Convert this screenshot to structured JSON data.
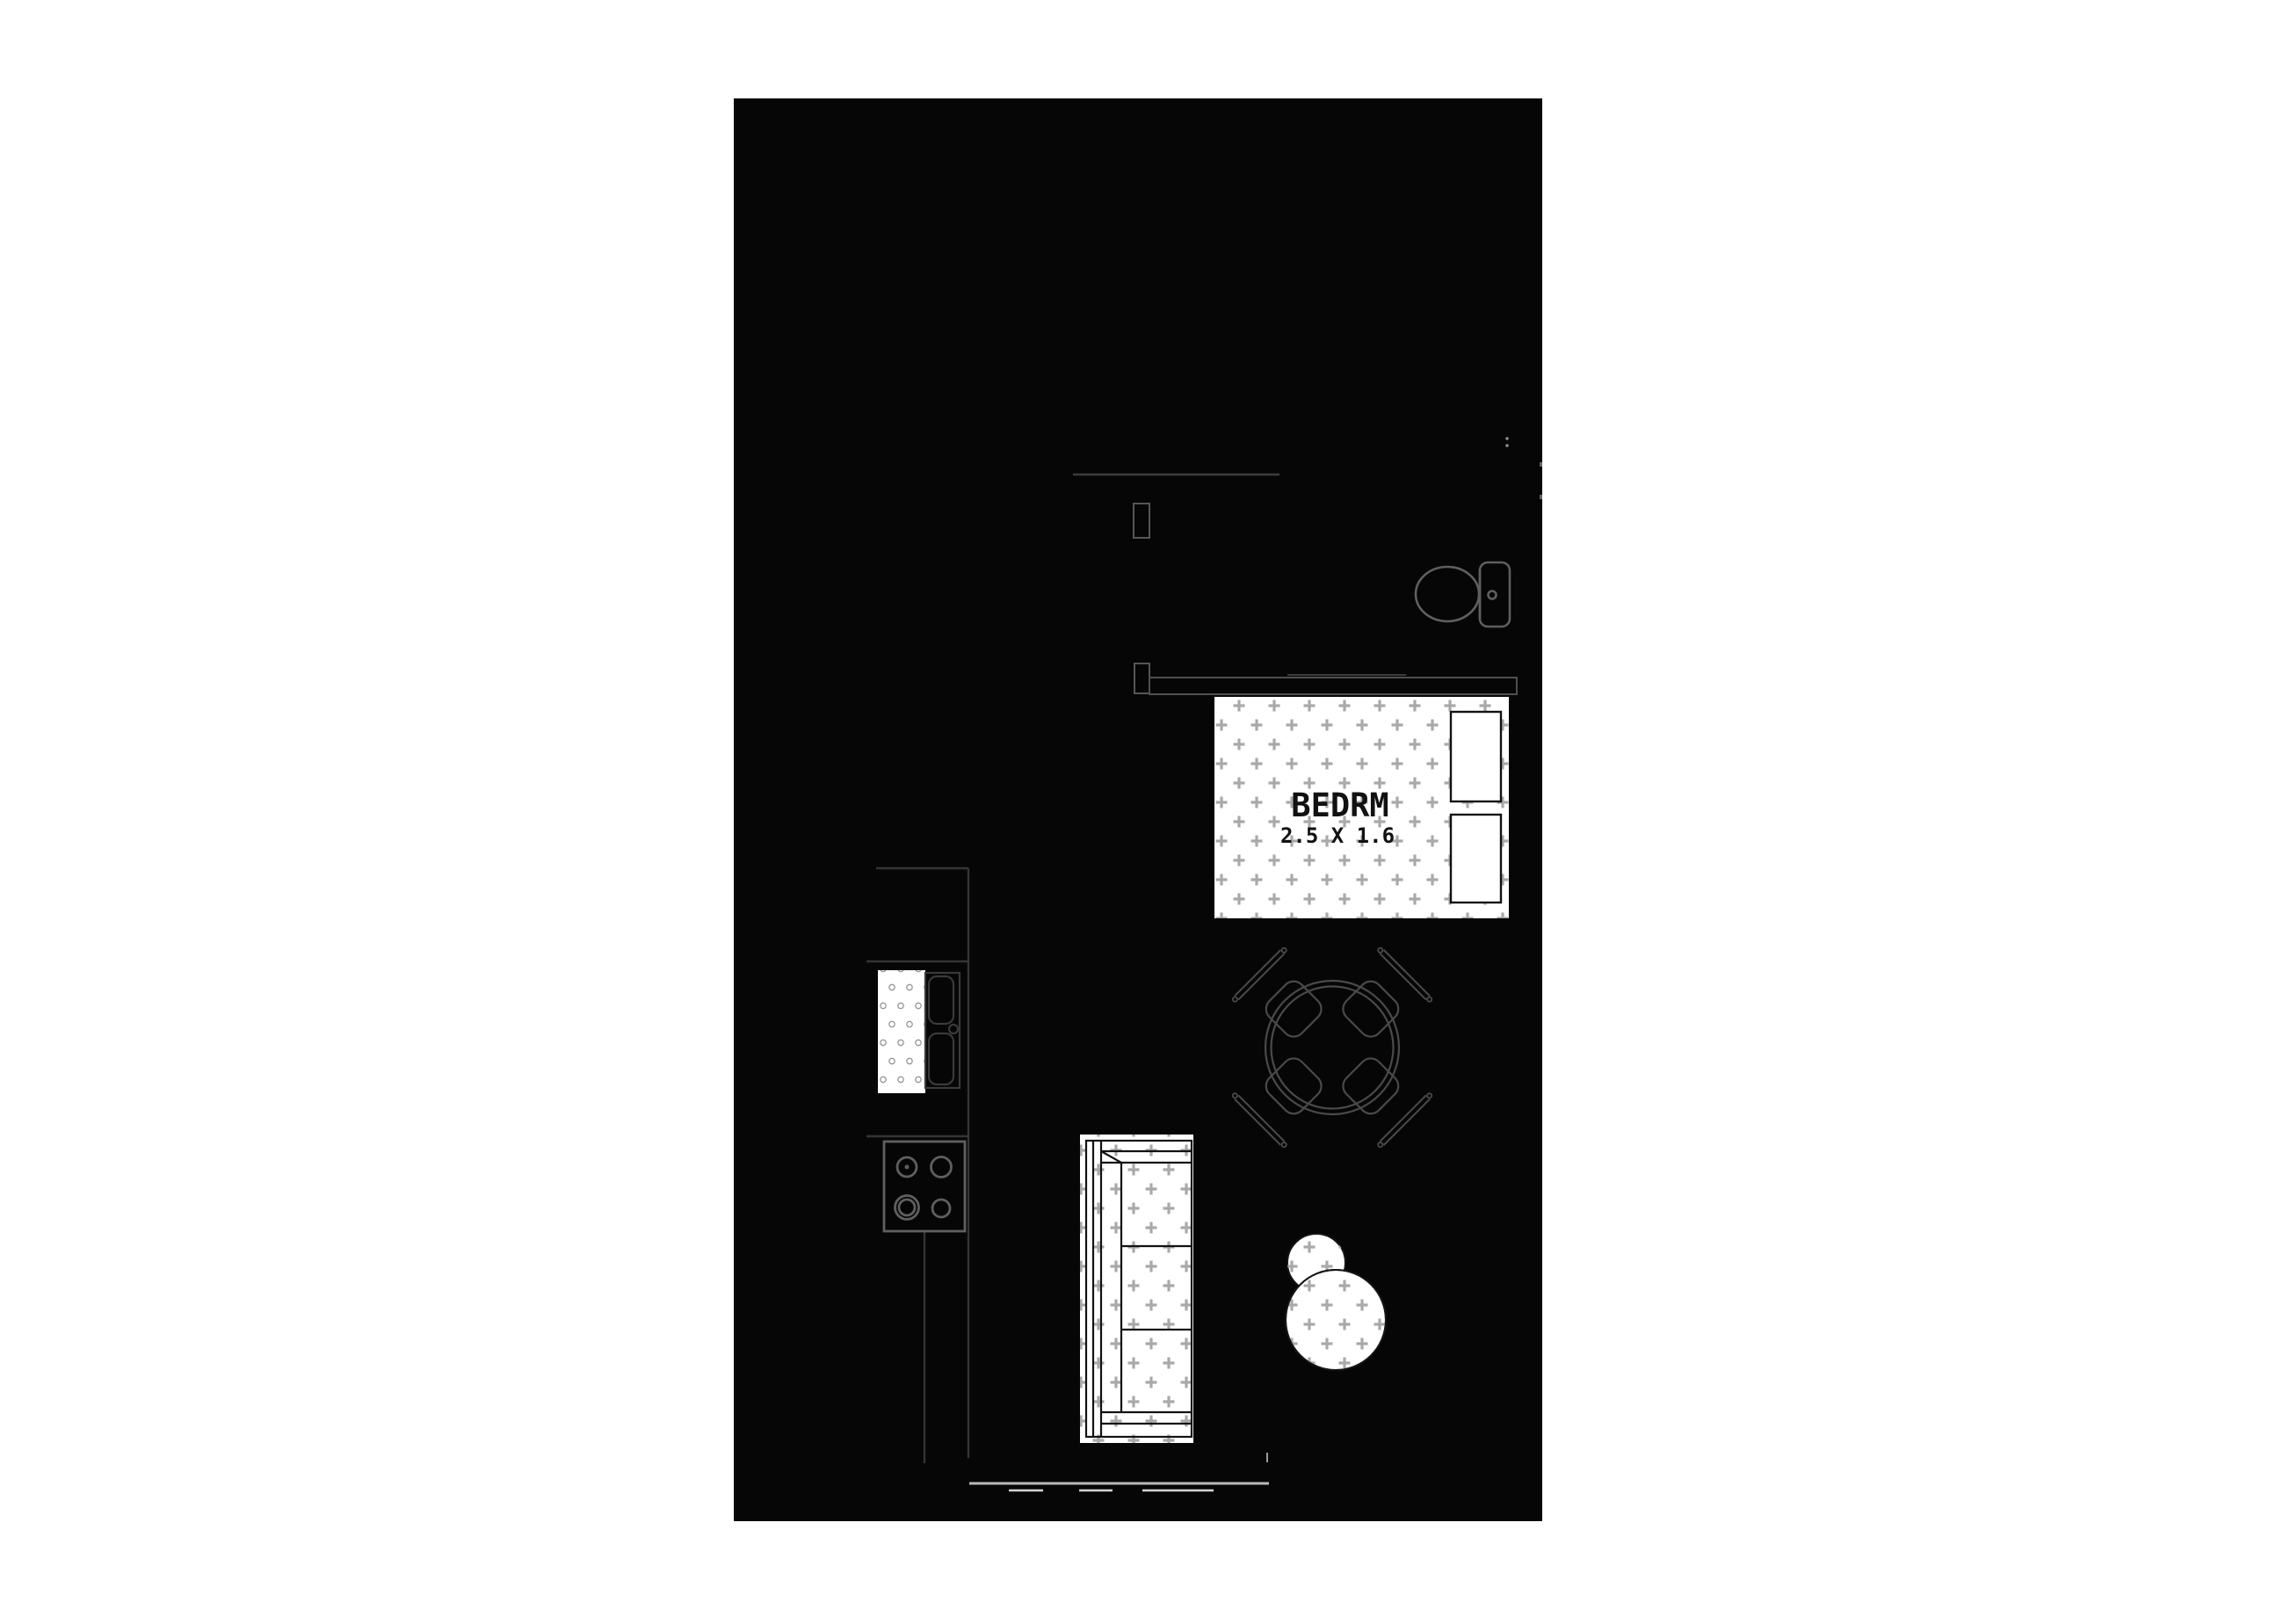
{
  "floorplan": {
    "rooms": {
      "bedroom": {
        "label": "BEDRM",
        "dimensions": "2.5 X 1.6"
      }
    },
    "colors": {
      "page_background": "#ffffff",
      "plan_fill": "#060606",
      "fixture_stroke": "#5f5f5f",
      "subtle_stroke": "#3c3c3c",
      "counter_stroke": "#343434",
      "furniture_outline": "#121212",
      "cross_pattern": "#a9a9a9",
      "dot_pattern": "#989898",
      "window_line": "#b9b9b9",
      "window_dash": "#d5d5d5",
      "white_fill": "#ffffff"
    }
  }
}
